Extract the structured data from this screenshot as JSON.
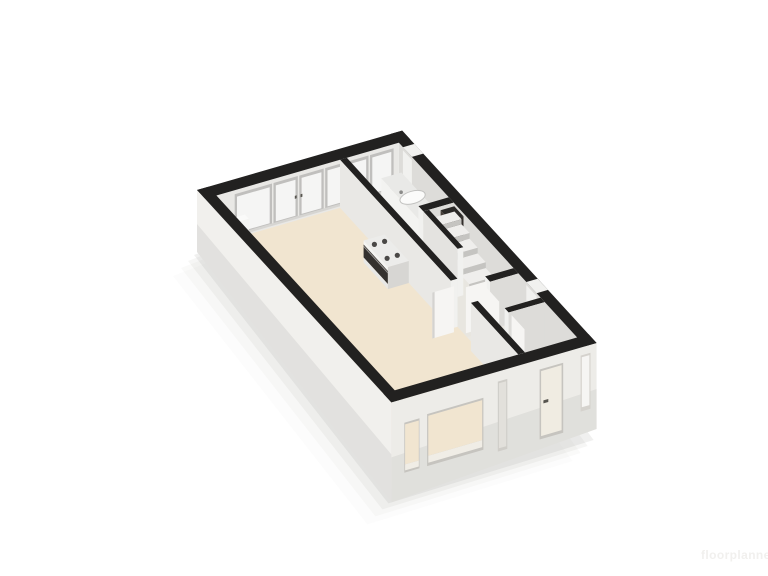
{
  "scene": {
    "type": "3d-floorplan-cutaway-render",
    "background": "#ffffff"
  },
  "watermark": {
    "text": "floorplanner"
  },
  "colors": {
    "wallCap": "#222120",
    "wallInnerLight": "#e9e8e5",
    "wallInnerMid": "#dddcd9",
    "wallEnd": "#f1f1ef",
    "floorMain": "#f1e5d0",
    "floorKitchen": "#ece7da",
    "floorHall": "#e8e6e0",
    "floorRooms": "#eae8e2",
    "facadeLeft": "#f1f0ed",
    "facadeFront": "#edece8",
    "glass": "#f5f5f4",
    "frame": "#c0bfbd",
    "sill": "#d6d5d2",
    "counterTop": "#e9e9e7",
    "counterFront": "#f3f3f1",
    "counterSide": "#dad9d6",
    "stepTop": "#efeeec",
    "stepRiser": "#c5c4c1",
    "ovenDark": "#34312e",
    "cabinetDark": "#46403b",
    "cabinetStripe": "#6e4b46",
    "doorLeaf": "#f6f5f3",
    "doorExt": "#f0ece2",
    "reveal": "#c6c4bf",
    "handleDark": "#57554f",
    "shadow": "#b3b2af",
    "watermark": "#f1f0ee"
  }
}
